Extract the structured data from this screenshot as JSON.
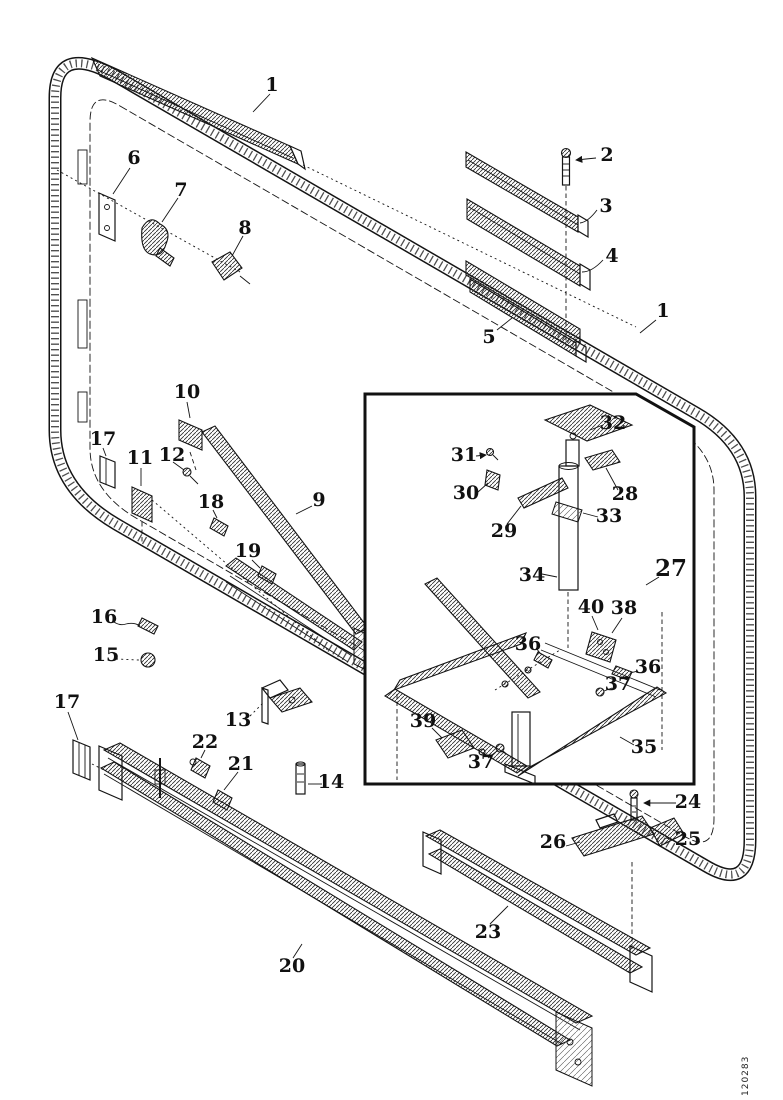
{
  "figure": {
    "type": "exploded-parts-diagram",
    "description": "Exploded parts view of a cab window/door frame assembly with detail inset",
    "figure_code": "120283",
    "colors": {
      "ink": "#141414",
      "background": "#ffffff"
    },
    "inset": {
      "shape": "rectangle-with-chamfered-top-right-corner"
    },
    "callouts": [
      {
        "part": "1",
        "x": 272,
        "y": 86
      },
      {
        "part": "2",
        "x": 607,
        "y": 156
      },
      {
        "part": "3",
        "x": 606,
        "y": 207
      },
      {
        "part": "4",
        "x": 612,
        "y": 257
      },
      {
        "part": "5",
        "x": 489,
        "y": 338
      },
      {
        "part": "1",
        "x": 663,
        "y": 312
      },
      {
        "part": "6",
        "x": 134,
        "y": 159
      },
      {
        "part": "7",
        "x": 181,
        "y": 191
      },
      {
        "part": "8",
        "x": 245,
        "y": 229
      },
      {
        "part": "10",
        "x": 187,
        "y": 393
      },
      {
        "part": "17",
        "x": 103,
        "y": 440
      },
      {
        "part": "11",
        "x": 140,
        "y": 459
      },
      {
        "part": "12",
        "x": 172,
        "y": 456
      },
      {
        "part": "18",
        "x": 211,
        "y": 503
      },
      {
        "part": "9",
        "x": 319,
        "y": 501
      },
      {
        "part": "19",
        "x": 248,
        "y": 552
      },
      {
        "part": "16",
        "x": 104,
        "y": 618
      },
      {
        "part": "15",
        "x": 106,
        "y": 656
      },
      {
        "part": "17",
        "x": 67,
        "y": 703
      },
      {
        "part": "13",
        "x": 238,
        "y": 721
      },
      {
        "part": "22",
        "x": 205,
        "y": 743
      },
      {
        "part": "21",
        "x": 241,
        "y": 765
      },
      {
        "part": "14",
        "x": 331,
        "y": 783
      },
      {
        "part": "20",
        "x": 292,
        "y": 967
      },
      {
        "part": "23",
        "x": 488,
        "y": 933
      },
      {
        "part": "24",
        "x": 688,
        "y": 803
      },
      {
        "part": "25",
        "x": 688,
        "y": 840
      },
      {
        "part": "26",
        "x": 553,
        "y": 843
      },
      {
        "part": "32",
        "x": 613,
        "y": 424
      },
      {
        "part": "31",
        "x": 464,
        "y": 456
      },
      {
        "part": "30",
        "x": 466,
        "y": 494
      },
      {
        "part": "28",
        "x": 625,
        "y": 495
      },
      {
        "part": "33",
        "x": 609,
        "y": 517
      },
      {
        "part": "29",
        "x": 504,
        "y": 532
      },
      {
        "part": "34",
        "x": 532,
        "y": 576
      },
      {
        "part": "27",
        "x": 671,
        "y": 570,
        "size": 23
      },
      {
        "part": "40",
        "x": 591,
        "y": 608
      },
      {
        "part": "38",
        "x": 624,
        "y": 609
      },
      {
        "part": "36",
        "x": 528,
        "y": 645
      },
      {
        "part": "36",
        "x": 648,
        "y": 668
      },
      {
        "part": "37",
        "x": 618,
        "y": 685
      },
      {
        "part": "39",
        "x": 423,
        "y": 722
      },
      {
        "part": "37",
        "x": 481,
        "y": 763
      },
      {
        "part": "35",
        "x": 644,
        "y": 748
      }
    ]
  }
}
